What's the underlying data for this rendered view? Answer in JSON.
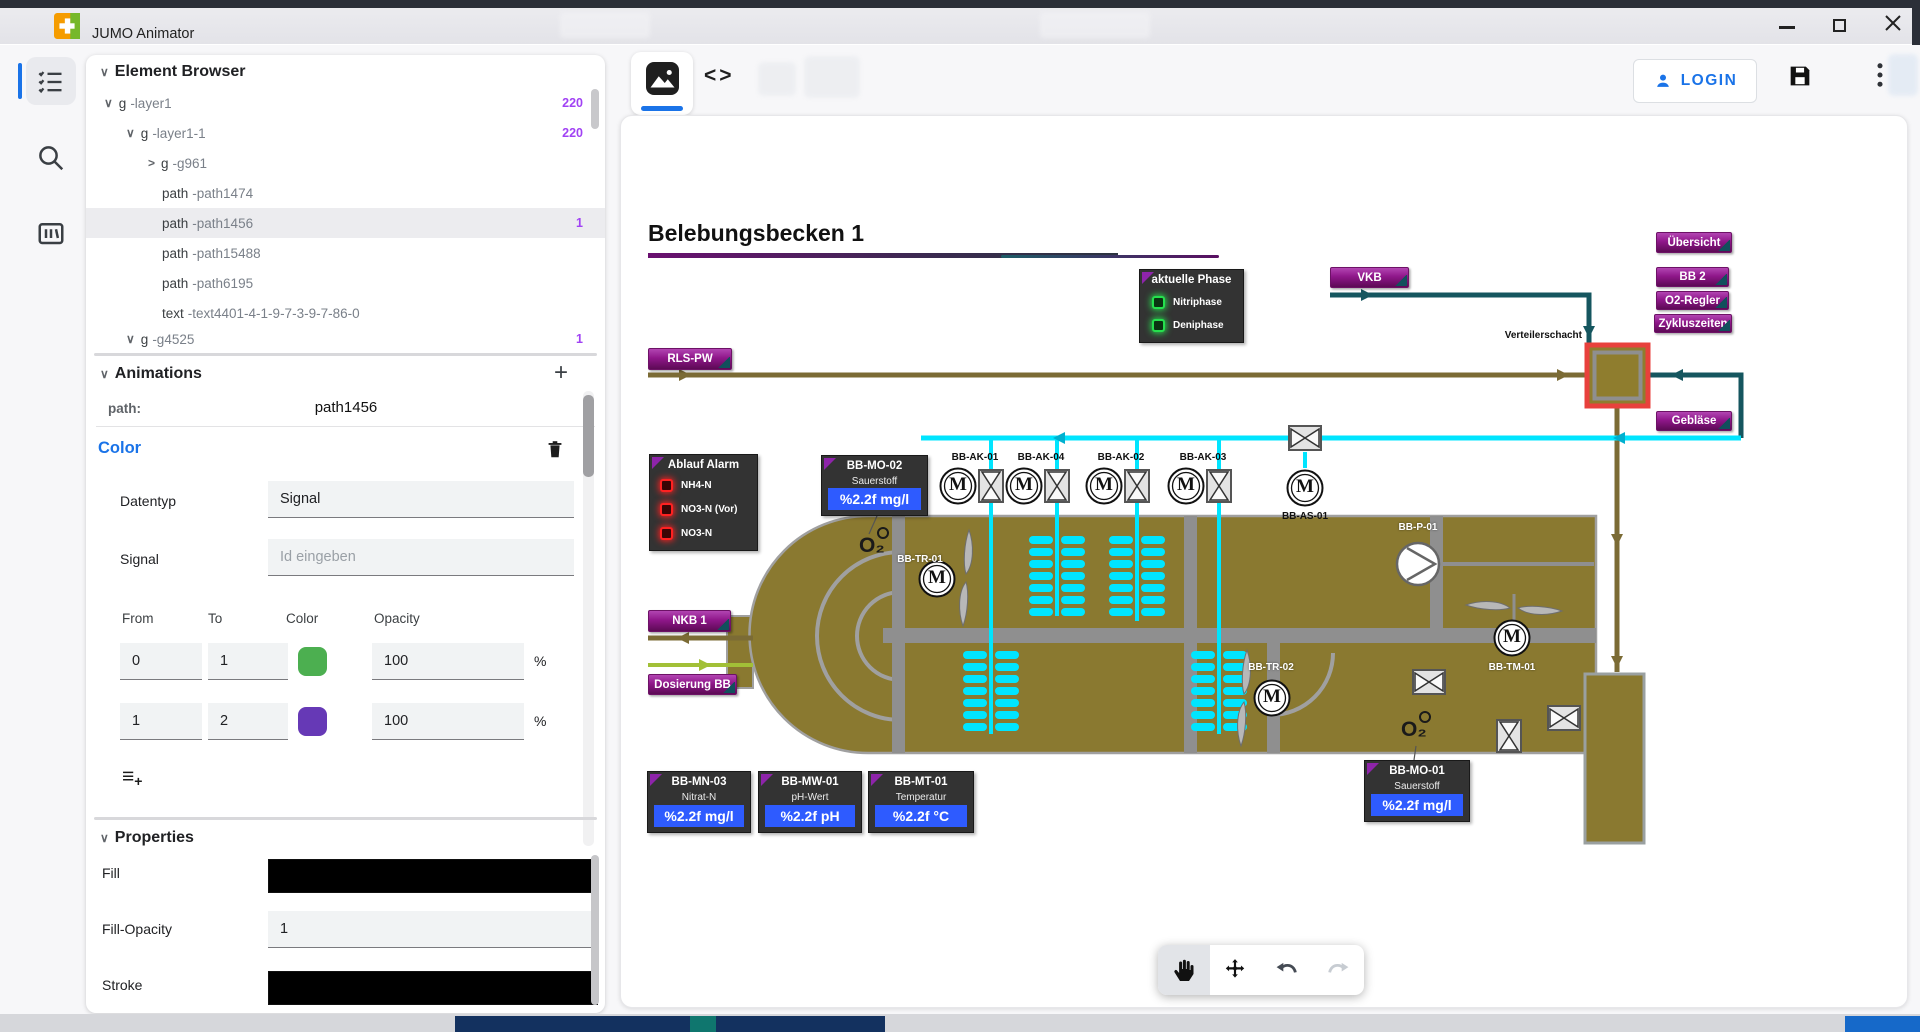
{
  "window": {
    "title": "JUMO Animator"
  },
  "element_browser": {
    "title": "Element Browser",
    "rows": [
      {
        "chev": "∨",
        "tag": "g",
        "id": "-layer1",
        "badge": "220"
      },
      {
        "chev": "∨",
        "tag": "g",
        "id": "-layer1-1",
        "badge": "220"
      },
      {
        "chev": ">",
        "tag": "g",
        "id": "-g961",
        "badge": ""
      },
      {
        "chev": "",
        "tag": "path",
        "id": "-path1474",
        "badge": ""
      },
      {
        "chev": "",
        "tag": "path",
        "id": "-path1456",
        "badge": "1"
      },
      {
        "chev": "",
        "tag": "path",
        "id": "-path15488",
        "badge": ""
      },
      {
        "chev": "",
        "tag": "path",
        "id": "-path6195",
        "badge": ""
      },
      {
        "chev": "",
        "tag": "text",
        "id": "-text4401-4-1-9-7-3-9-7-86-0",
        "badge": ""
      },
      {
        "chev": "∨",
        "tag": "g",
        "id": "-g4525",
        "badge": "1"
      }
    ]
  },
  "animations": {
    "title": "Animations",
    "path_label": "path:",
    "path_value": "path1456",
    "type_label": "Color",
    "datentyp_label": "Datentyp",
    "datentyp_value": "Signal",
    "signal_label": "Signal",
    "signal_placeholder": "Id eingeben",
    "headers": {
      "from": "From",
      "to": "To",
      "color": "Color",
      "opacity": "Opacity"
    },
    "rows": [
      {
        "from": "0",
        "to": "1",
        "color": "#4caf50",
        "opacity": "100",
        "unit": "%"
      },
      {
        "from": "1",
        "to": "2",
        "color": "#6639b6",
        "opacity": "100",
        "unit": "%"
      }
    ]
  },
  "properties": {
    "title": "Properties",
    "fill_label": "Fill",
    "fill_color": "#000000",
    "fill_opacity_label": "Fill-Opacity",
    "fill_opacity_value": "1",
    "stroke_label": "Stroke",
    "stroke_color": "#000000"
  },
  "topbar": {
    "login_label": "LOGIN"
  },
  "icons": {
    "section_chevron": "∨",
    "plus": "+",
    "code": "<>",
    "add_row_lines": "≡",
    "add_row_plus": "+"
  },
  "diagram": {
    "title": "Belebungsbecken 1",
    "phase_panel": {
      "title": "aktuelle Phase",
      "led1": "Nitriphase",
      "led2": "Deniphase"
    },
    "alarm_panel": {
      "title": "Ablauf Alarm",
      "led1": "NH4-N",
      "led2": "NO3-N (Vor)",
      "led3": "NO3-N"
    },
    "buttons": {
      "rls": "RLS-PW",
      "vkb": "VKB",
      "uebersicht": "Übersicht",
      "bb2": "BB 2",
      "o2regler": "O2-Regler",
      "zyklus": "Zykluszeiten",
      "geblaese": "Gebläse",
      "nkb": "NKB 1",
      "dosierung": "Dosierung BB"
    },
    "labels": {
      "verteilerschacht": "Verteilerschacht",
      "ak01": "BB-AK-01",
      "ak04": "BB-AK-04",
      "ak02": "BB-AK-02",
      "ak03": "BB-AK-03",
      "as01": "BB-AS-01",
      "tr01": "BB-TR-01",
      "tr02": "BB-TR-02",
      "p01": "BB-P-01",
      "tm01": "BB-TM-01",
      "o2": "O₂",
      "motor": "M"
    },
    "meters": {
      "mo02": {
        "title": "BB-MO-02",
        "param": "Sauerstoff",
        "value": "%2.2f mg/l"
      },
      "mn03": {
        "title": "BB-MN-03",
        "param": "Nitrat-N",
        "value": "%2.2f mg/l"
      },
      "mw01": {
        "title": "BB-MW-01",
        "param": "pH-Wert",
        "value": "%2.2f pH"
      },
      "mt01": {
        "title": "BB-MT-01",
        "param": "Temperatur",
        "value": "%2.2f °C"
      },
      "mo01": {
        "title": "BB-MO-01",
        "param": "Sauerstoff",
        "value": "%2.2f mg/l"
      }
    }
  }
}
